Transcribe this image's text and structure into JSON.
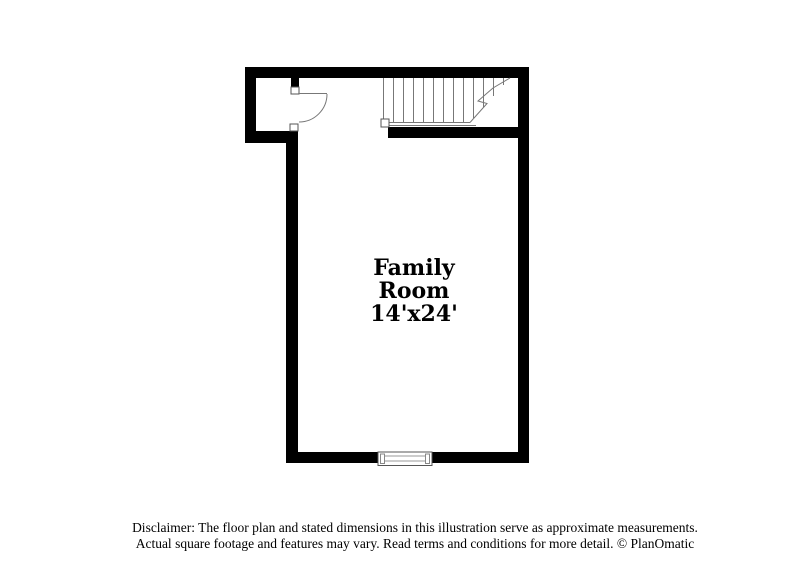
{
  "room": {
    "name_line1": "Family",
    "name_line2": "Room",
    "dimensions": "14'x24'"
  },
  "footer": {
    "disclaimer_line1": "Disclaimer: The floor plan and stated dimensions in this illustration serve as approximate measurements.",
    "disclaimer_line2": "Actual square footage and features may vary. Read terms and conditions for more detail. © PlanOmatic"
  },
  "colors": {
    "wall": "#000000",
    "line": "#777777",
    "line-dark": "#555555",
    "text": "#000000",
    "bg": "#ffffff"
  }
}
